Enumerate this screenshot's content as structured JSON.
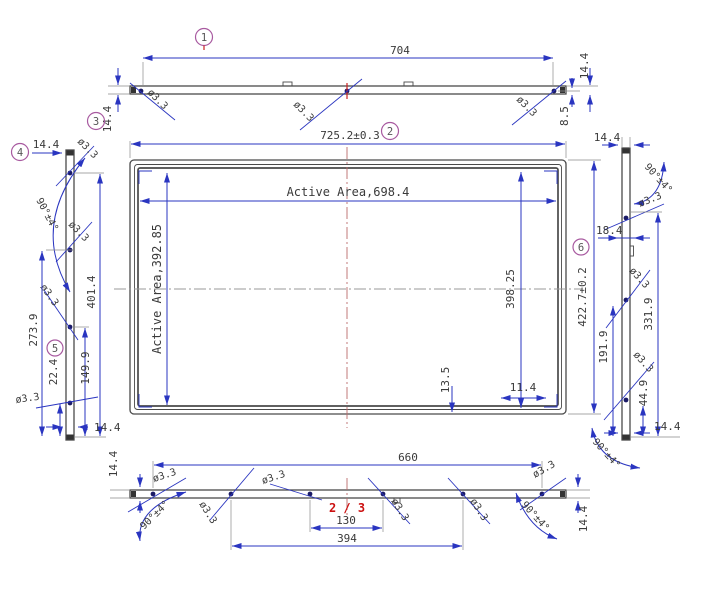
{
  "page": {
    "indicator": "2 / 3"
  },
  "colors": {
    "dimension_blue": "#2a35c0",
    "outline_gray": "#4a4a4a",
    "centerline_red": "#bb6a6a",
    "marker_purple": "#a85aa0",
    "page_red": "#cc1111"
  },
  "views": {
    "top": {
      "label": "1",
      "width": "704",
      "left_thickness": "14.4",
      "right_thickness": "14.4",
      "hole_edge_offset": "8.5",
      "hole_dia": "ø3.3",
      "end_label": "3",
      "end_thickness": "14.4"
    },
    "front": {
      "label": "2",
      "overall_width": "725.2±0.3",
      "active_width": "Active Area,698.4",
      "active_height": "Active Area,392.85",
      "inner_height": "398.25",
      "bottom_inset": "13.5",
      "corner_inset": "11.4"
    },
    "left": {
      "label_top": "4",
      "label_mid": "5",
      "thickness": "14.4",
      "angle": "90°±4°",
      "hole_dia": "ø3.3",
      "hole1": "401.4",
      "hole2": "273.9",
      "hole3": "149.9",
      "hole4": "22.4",
      "bottom_thickness": "14.4"
    },
    "right": {
      "label": "6",
      "overall_height": "422.7±0.2",
      "top_thickness": "14.4",
      "angle": "90°±4°",
      "hole_dia": "ø3.3",
      "hole_offset_top": "18.4",
      "span": "331.9",
      "hole2": "191.9",
      "hole3": "44.9",
      "bottom_thickness": "14.4"
    },
    "bottom": {
      "width": "660",
      "pitch_inner": "130",
      "pitch_outer": "394",
      "left_thickness": "14.4",
      "right_thickness": "14.4",
      "angle": "90°±4°",
      "hole_dia": "ø3.3"
    }
  }
}
